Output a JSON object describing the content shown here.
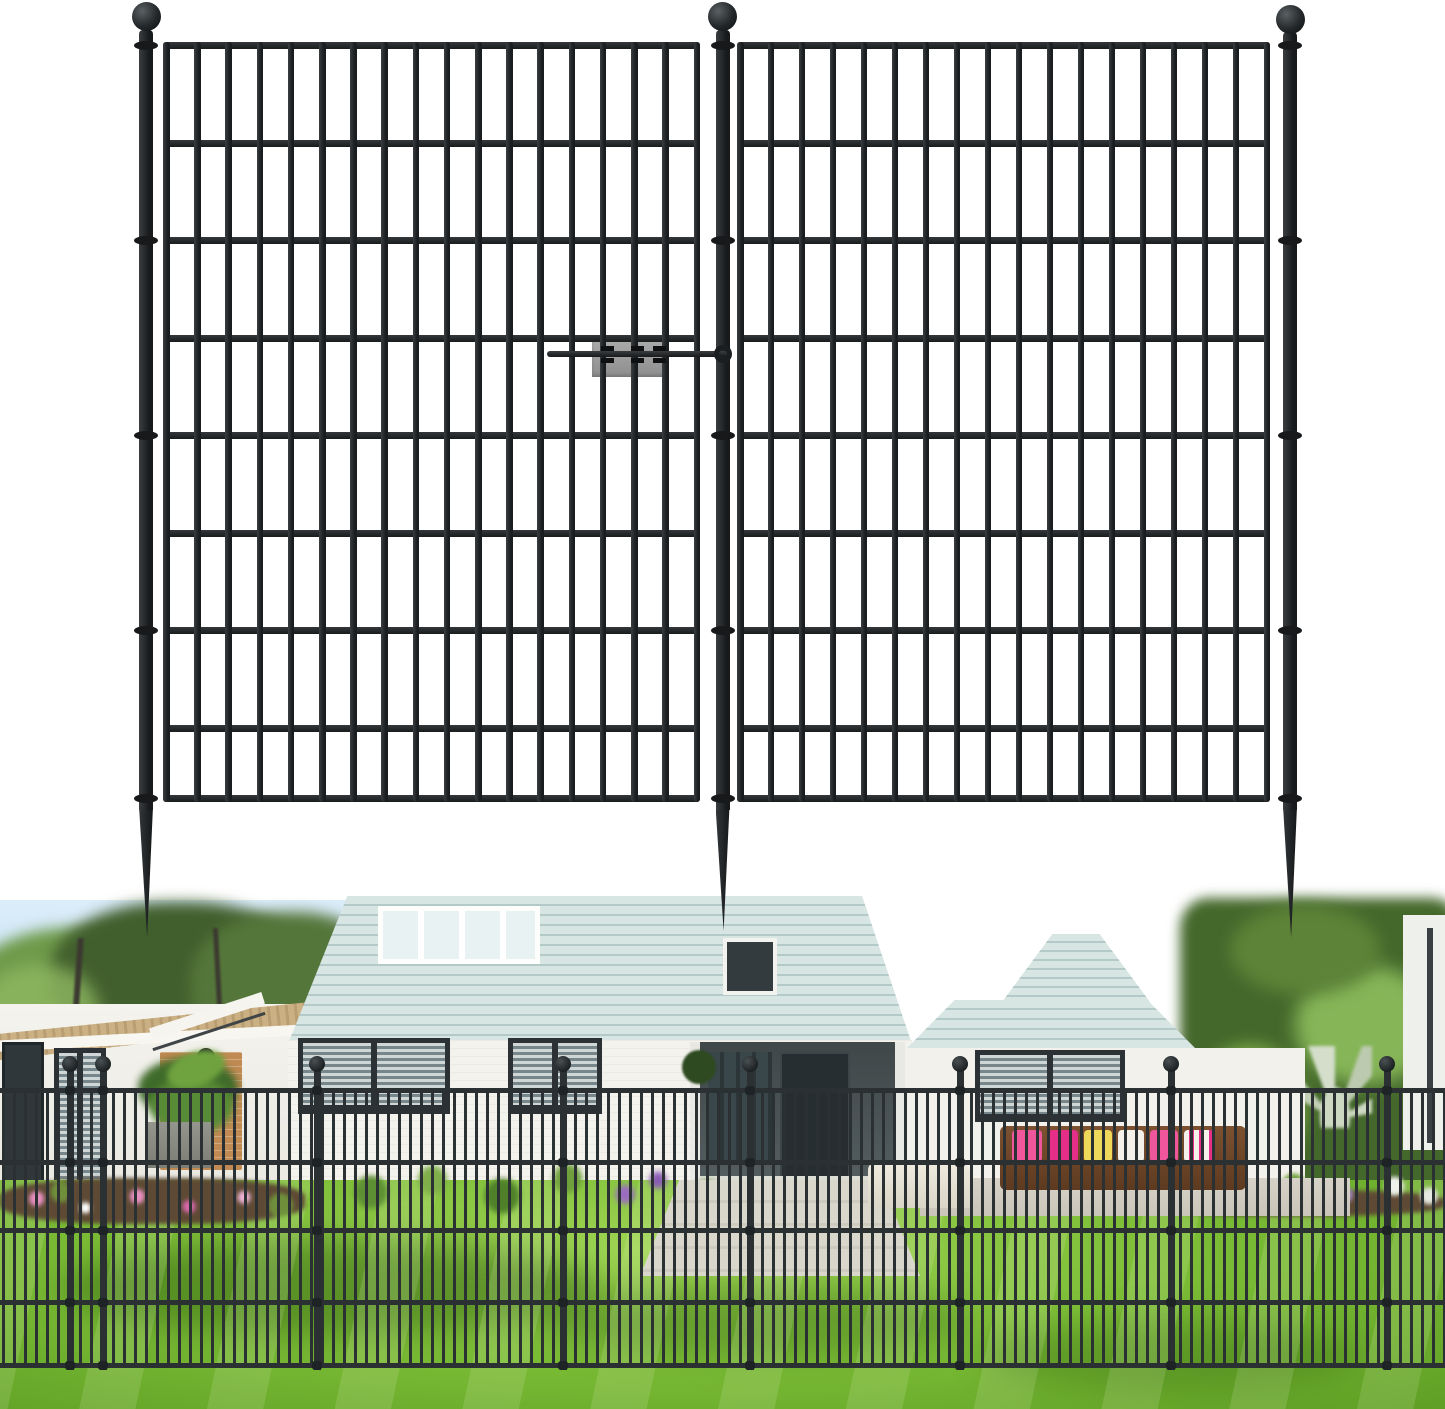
{
  "canvas": {
    "width": 1445,
    "height": 1409
  },
  "colors": {
    "fence_illustration": "#212527",
    "fence_photo": "#2b3033",
    "connector_plate": "#9c9c9c",
    "sky": "#b9ddf2",
    "siding": "#d7e5e3",
    "siding_line": "#b3cac8",
    "white_wall": "#f4f2ec",
    "brick_accent": "#c08a52",
    "roof_tan": "#c2a77b",
    "window_dark": "#2b3134",
    "louver": "#cfd7d6",
    "lawn_light": "#9ed453",
    "lawn": "#7cbd36",
    "lawn_dark": "#5f9f25",
    "mulch": "#5e4a34",
    "wicker": "#6f4527",
    "cushion_pink": "#f0569c",
    "cushion_magenta": "#e42e87",
    "cushion_yellow": "#efd95b",
    "cushion_white": "#f4f1ea",
    "pavement": "#d8d4c9",
    "hedge": "#44682b",
    "flower_purple": "#9a6cc0",
    "flower_pink": "#e88fc2"
  },
  "illustration": {
    "rails_y": [
      42,
      140,
      237,
      335,
      432,
      530,
      627,
      725,
      795
    ],
    "rail_h": 7,
    "bar_w": 6.5,
    "bar_top": 42,
    "bar_bottom": 802,
    "panels": [
      {
        "name": "fence-panel-left",
        "x0": 163,
        "x1": 700,
        "bars": 18
      },
      {
        "name": "fence-panel-right",
        "x0": 737,
        "x1": 1270,
        "bars": 18
      }
    ],
    "post_w": 14,
    "ball_r": 14.5,
    "posts": [
      {
        "name": "left-post",
        "cx": 146,
        "top": 30,
        "ball_cy": 16,
        "spike_tip": 938
      },
      {
        "name": "middle-post",
        "cx": 722.5,
        "top": 30,
        "ball_cy": 16,
        "spike_tip": 931
      },
      {
        "name": "right-post",
        "cx": 1290,
        "top": 32,
        "ball_cy": 19,
        "spike_tip": 938
      }
    ],
    "collars_y": [
      45.5,
      240.5,
      435.5,
      630.5,
      798.5
    ],
    "connector": {
      "plate": {
        "x": 592,
        "y": 335,
        "w": 76,
        "h": 42
      },
      "rod": {
        "x": 547,
        "y": 351,
        "w": 182,
        "h": 6
      },
      "hook": {
        "cx": 723,
        "cy": 354,
        "r": 9
      },
      "clips_x": [
        601,
        631,
        653
      ],
      "clip_rows_y": [
        346,
        358
      ]
    }
  },
  "photo": {
    "top": 900,
    "fence": {
      "rails_y": [
        1088,
        1160,
        1228,
        1300,
        1363
      ],
      "rail_h": 5,
      "bar_w": 3,
      "bar_spacing": 11,
      "bar_top": 1088,
      "bar_bottom": 1368,
      "posts_x": [
        70,
        103,
        317,
        563,
        750,
        960,
        1171,
        1387
      ],
      "post_w": 7,
      "post_top": 1058,
      "post_bottom": 1370,
      "ball_cy": 1064,
      "ball_r": 8
    }
  }
}
